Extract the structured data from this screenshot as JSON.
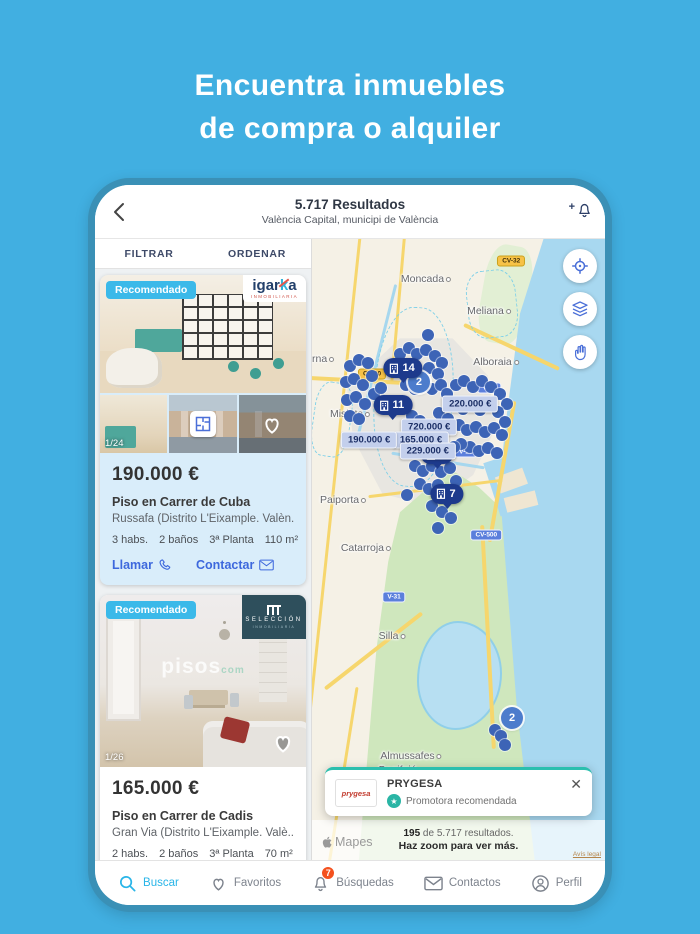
{
  "page_title": {
    "line1": "Encuentra inmuebles",
    "line2": "de compra o alquiler"
  },
  "header": {
    "results": "5.717 Resultados",
    "location": "València Capital, municipi de València"
  },
  "tabs": {
    "filter": "FILTRAR",
    "sort": "ORDENAR"
  },
  "cards": [
    {
      "badge": "Recomendado",
      "agency": {
        "prefix": "igar",
        "accent": "k",
        "suffix": "a",
        "sub": "INMOBILIARIA"
      },
      "photo_counter": "1/24",
      "price": "190.000 €",
      "title": "Piso en Carrer de Cuba",
      "location": "Russafa (Distrito L'Eixample. Valèn...",
      "features": [
        "3 habs.",
        "2 baños",
        "3ª Planta",
        "110 m²"
      ],
      "call_label": "Llamar",
      "contact_label": "Contactar"
    },
    {
      "badge": "Recomendado",
      "agency": {
        "name": "SELECCIÓN",
        "sub": "INMOBILIARIA"
      },
      "photo_counter": "1/26",
      "watermark": "pisos",
      "watermark_sub": "com",
      "price": "165.000 €",
      "title": "Piso en Carrer de Cadis",
      "location": "Gran Via (Distrito L'Eixample. Valè...",
      "features": [
        "2 habs.",
        "2 baños",
        "3ª Planta",
        "70 m²"
      ]
    }
  ],
  "map": {
    "places": [
      {
        "name": "Moncada",
        "x": 38.9,
        "y": 6.5
      },
      {
        "name": "Meliana",
        "x": 60.4,
        "y": 11.6
      },
      {
        "name": "Alboraia",
        "x": 62.8,
        "y": 19.8
      },
      {
        "name": "erna",
        "x": 2.8,
        "y": 19.4
      },
      {
        "name": "Mislata",
        "x": 13,
        "y": 28.2
      },
      {
        "name": "Paiporta",
        "x": 10.6,
        "y": 42.1
      },
      {
        "name": "Catarroja",
        "x": 18.4,
        "y": 49.8
      },
      {
        "name": "Silla",
        "x": 27.3,
        "y": 64
      },
      {
        "name": "Almussafes",
        "x": 33.8,
        "y": 83.2
      },
      {
        "name": "Benifaió",
        "x": 30.4,
        "y": 85.5
      }
    ],
    "road_badges": [
      {
        "label": "CV-32",
        "style": "yellow",
        "x": 68,
        "y": 3.5
      },
      {
        "label": "CV-30",
        "style": "yellow",
        "x": 20.5,
        "y": 21.8
      },
      {
        "label": "V-21",
        "style": "blue",
        "x": 60.5,
        "y": 24
      },
      {
        "label": "V-15",
        "style": "blue",
        "x": 52.5,
        "y": 34.3
      },
      {
        "label": "CV-500",
        "style": "blue",
        "x": 59.5,
        "y": 47.6
      },
      {
        "label": "V-31",
        "style": "blue",
        "x": 28,
        "y": 57.6
      }
    ],
    "price_pins": [
      {
        "label": "220.000 €",
        "x": 54,
        "y": 26.5
      },
      {
        "label": "720.000 €",
        "x": 40,
        "y": 30.2
      },
      {
        "label": "165.000 €",
        "x": 37.2,
        "y": 32.3
      },
      {
        "label": "229.000 €",
        "x": 39.5,
        "y": 34.2
      },
      {
        "label": "190.000 €",
        "x": 19.5,
        "y": 32.3
      }
    ],
    "cluster_pins": [
      {
        "count": "14",
        "x": 31.1,
        "y": 22.4
      },
      {
        "count": "11",
        "x": 27.6,
        "y": 28.4
      },
      {
        "count": "2",
        "x": 42.7,
        "y": 36.3
      },
      {
        "count": "7",
        "x": 46.1,
        "y": 42.6
      }
    ],
    "cluster_circles": [
      {
        "count": "2",
        "x": 36.5,
        "y": 23.1
      },
      {
        "count": "2",
        "x": 68.3,
        "y": 77.1
      }
    ],
    "dots": [
      [
        13,
        20.5
      ],
      [
        16,
        19.5
      ],
      [
        19,
        20
      ],
      [
        11.5,
        23
      ],
      [
        14.5,
        22.5
      ],
      [
        17.5,
        23.5
      ],
      [
        20.5,
        22
      ],
      [
        12,
        26
      ],
      [
        15,
        25.5
      ],
      [
        18,
        26.5
      ],
      [
        21,
        25
      ],
      [
        23.5,
        24
      ],
      [
        13,
        28.5
      ],
      [
        16,
        29
      ],
      [
        30,
        18.5
      ],
      [
        33,
        17.5
      ],
      [
        36,
        18.5
      ],
      [
        39,
        17.8
      ],
      [
        42,
        18.8
      ],
      [
        44.5,
        20
      ],
      [
        31,
        21
      ],
      [
        34,
        20.5
      ],
      [
        37,
        21.5
      ],
      [
        40,
        20.8
      ],
      [
        43,
        21.8
      ],
      [
        32,
        23.5
      ],
      [
        35,
        24.2
      ],
      [
        38,
        23.2
      ],
      [
        41,
        24.2
      ],
      [
        44,
        23.5
      ],
      [
        46,
        25
      ],
      [
        49,
        23.5
      ],
      [
        52,
        22.8
      ],
      [
        55,
        23.8
      ],
      [
        58,
        22.9
      ],
      [
        61,
        23.9
      ],
      [
        64,
        25
      ],
      [
        66.5,
        26.5
      ],
      [
        48.5,
        26.5
      ],
      [
        51.5,
        27.3
      ],
      [
        54.5,
        26.6
      ],
      [
        57.5,
        27.5
      ],
      [
        60.5,
        26.8
      ],
      [
        63.5,
        27.8
      ],
      [
        66,
        29.5
      ],
      [
        50,
        30
      ],
      [
        53,
        30.8
      ],
      [
        56,
        30.2
      ],
      [
        59,
        31
      ],
      [
        62,
        30.4
      ],
      [
        65,
        31.5
      ],
      [
        54,
        33.5
      ],
      [
        57,
        34.2
      ],
      [
        60,
        33.6
      ],
      [
        63,
        34.5
      ],
      [
        51,
        33
      ],
      [
        34,
        28.5
      ],
      [
        37,
        29.3
      ],
      [
        43.5,
        28
      ],
      [
        46.5,
        29
      ],
      [
        35,
        36.5
      ],
      [
        38,
        37.3
      ],
      [
        41,
        36.6
      ],
      [
        44,
        37.5
      ],
      [
        47,
        36.8
      ],
      [
        37,
        39.5
      ],
      [
        40,
        40.2
      ],
      [
        43,
        39.6
      ],
      [
        46,
        40.5
      ],
      [
        48.5,
        33.5
      ],
      [
        49,
        39
      ],
      [
        41,
        43
      ],
      [
        44.5,
        44
      ],
      [
        47.5,
        45
      ],
      [
        43,
        46.5
      ],
      [
        39.5,
        15.5
      ],
      [
        32.5,
        41.3
      ],
      [
        62.5,
        79
      ],
      [
        64.5,
        80
      ],
      [
        66,
        81.5
      ]
    ]
  },
  "promo": {
    "logo": "prygesa",
    "name": "PRYGESA",
    "tag": "Promotora recomendada"
  },
  "results_bar": {
    "count": "195",
    "suffix": " de 5.717 resultados.",
    "hint": "Haz zoom para ver más.",
    "attribution": "Mapes",
    "legal": "Avís legal"
  },
  "tabbar": [
    {
      "label": "Buscar"
    },
    {
      "label": "Favoritos"
    },
    {
      "label": "Búsquedas",
      "badge": "7"
    },
    {
      "label": "Contactos"
    },
    {
      "label": "Perfil"
    }
  ],
  "colors": {
    "background_blue": "#41afe1",
    "frame_blue": "#3a90b6",
    "accent_cyan": "#3bb9e9",
    "link_blue": "#3d68dd",
    "pin_navy": "#1d3a8c",
    "dot_blue": "#3d64b6",
    "badge_orange": "#f4511e",
    "promo_teal": "#2ab5a5",
    "card_highlight": "#d9edfa"
  }
}
